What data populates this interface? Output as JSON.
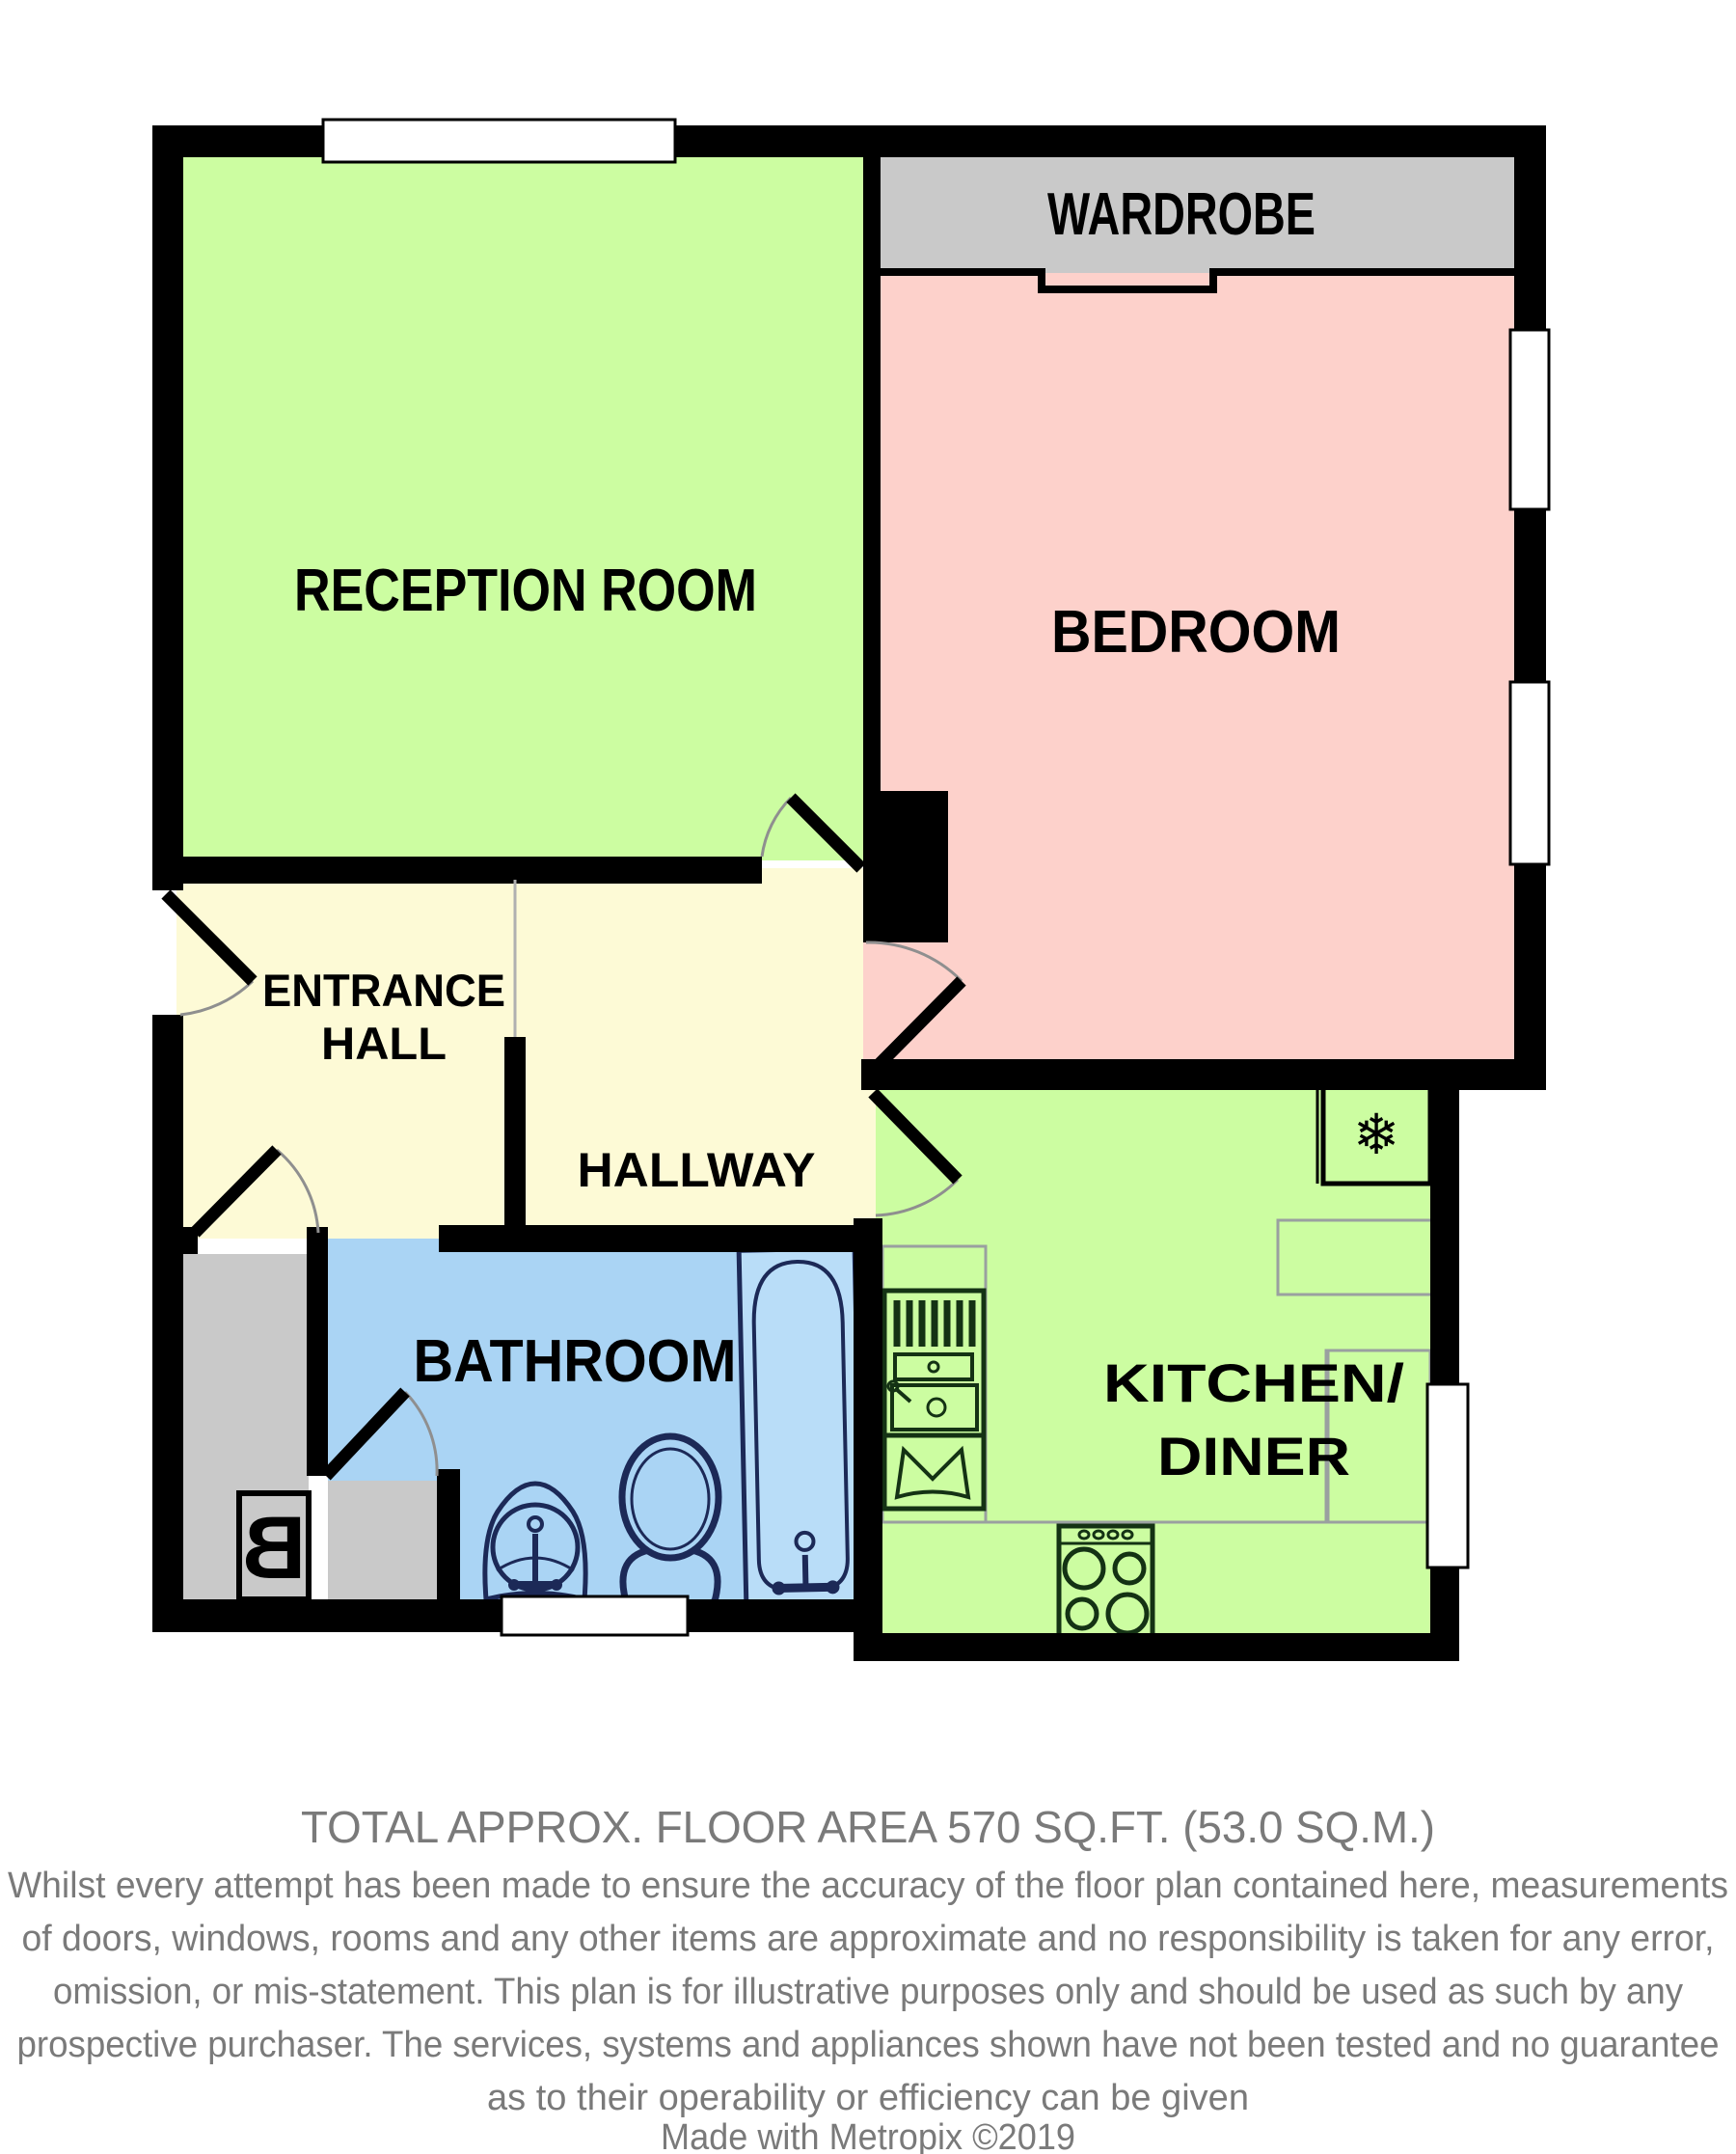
{
  "plan": {
    "rooms": {
      "reception": {
        "label": "RECEPTION ROOM"
      },
      "wardrobe": {
        "label": "WARDROBE"
      },
      "bedroom": {
        "label": "BEDROOM"
      },
      "entrance_hall": {
        "label_line1": "ENTRANCE",
        "label_line2": "HALL"
      },
      "hallway": {
        "label": "HALLWAY"
      },
      "bathroom": {
        "label": "BATHROOM"
      },
      "kitchen_diner": {
        "label_line1": "KITCHEN/",
        "label_line2": "DINER"
      }
    },
    "icons": {
      "boiler_letter": "B",
      "fridge_snowflake": "❄"
    },
    "colors": {
      "reception_green": "#ccfda1",
      "kitchen_green": "#ccfda1",
      "bedroom_pink": "#fdd1cb",
      "hall_cream": "#fdfad6",
      "bathroom_blue": "#aad4f4",
      "cupboard_gray": "#c9c9c9",
      "wall_black": "#000000",
      "bath_fixture_navy": "#1c2957",
      "footer_gray": "#7a7a7a"
    }
  },
  "footer": {
    "title": "TOTAL APPROX. FLOOR AREA 570 SQ.FT. (53.0 SQ.M.)",
    "disclaimer_lines": [
      "Whilst every attempt has been made to ensure the accuracy of the floor plan contained here, measurements",
      "of doors, windows, rooms and any other items are approximate and no responsibility is taken for any error,",
      "omission, or mis-statement. This plan is for illustrative purposes only and should be used as such by any",
      "prospective purchaser. The services, systems and appliances shown have not been tested and no guarantee",
      "as to their operability or efficiency can be given"
    ],
    "credit": "Made with Metropix ©2019"
  }
}
